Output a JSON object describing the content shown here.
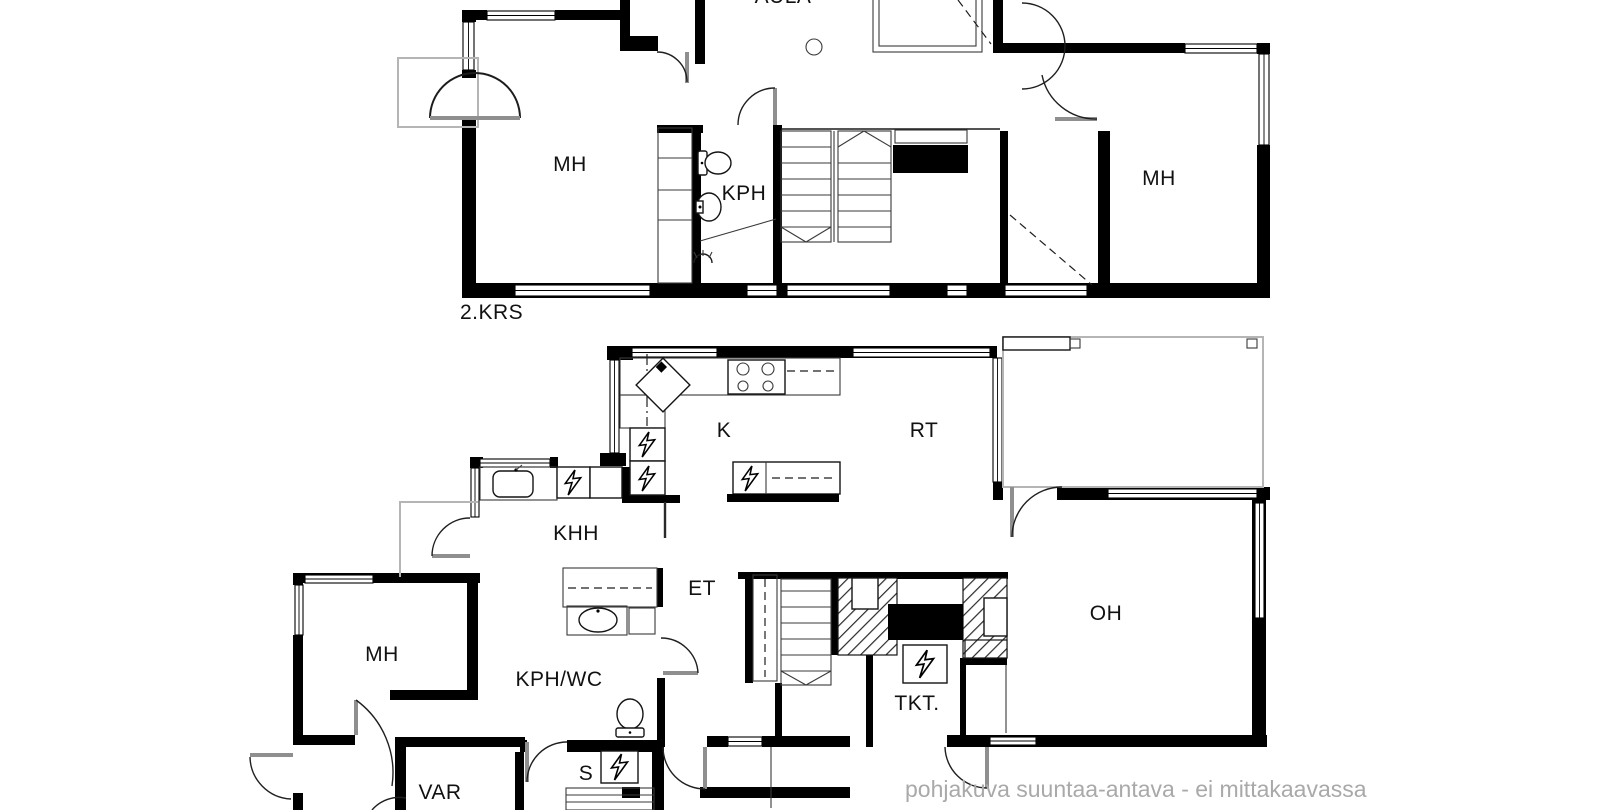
{
  "plan": {
    "floor2": {
      "floor_label": "2.KRS",
      "rooms": {
        "aula": "AULA",
        "mh_left": "MH",
        "kph": "KPH",
        "mh_right": "MH"
      }
    },
    "floor1": {
      "rooms": {
        "k": "K",
        "rt": "RT",
        "khh": "KHH",
        "et": "ET",
        "mh": "MH",
        "kph_wc": "KPH/WC",
        "var": "VAR",
        "s": "S",
        "tkt": "TKT.",
        "oh": "OH"
      }
    },
    "footer_note": "pohjakuva suuntaa-antava - ei mittakaavassa",
    "colors": {
      "walls": "#000000",
      "background": "#ffffff",
      "footer_text": "#a9a9a9",
      "label_text": "#111111"
    }
  }
}
